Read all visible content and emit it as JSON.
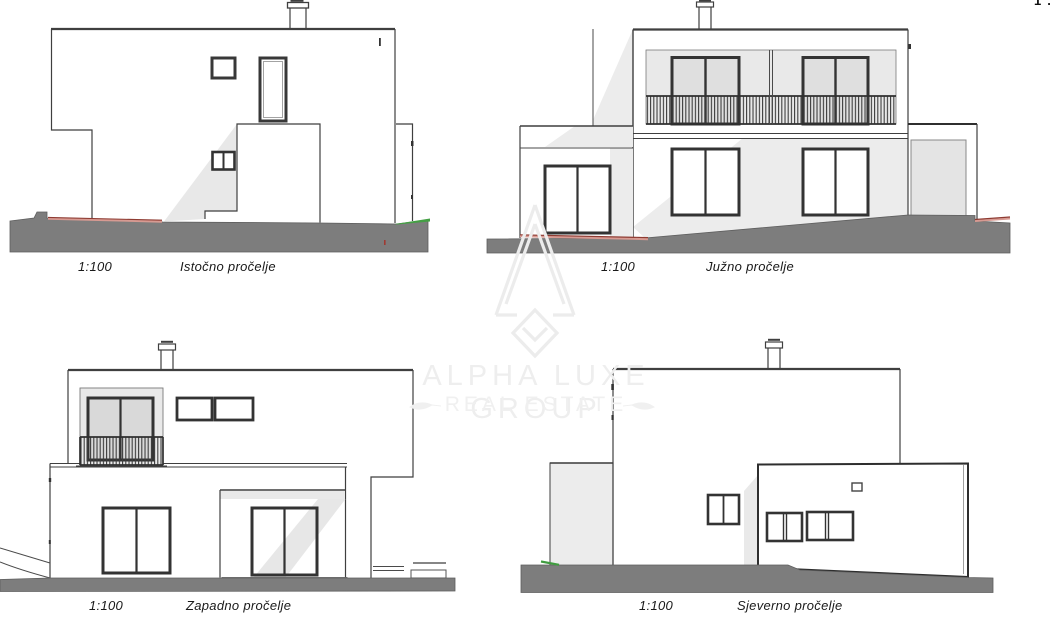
{
  "sheet": {
    "type": "architectural-elevations",
    "background": "#ffffff",
    "drawing_scale": "1:100"
  },
  "elevations": [
    {
      "id": "east",
      "scale_label": "1:100",
      "name_label": "Istočno pročelje"
    },
    {
      "id": "south",
      "scale_label": "1:100",
      "name_label": "Južno pročelje"
    },
    {
      "id": "west",
      "scale_label": "1:100",
      "name_label": "Zapadno pročelje"
    },
    {
      "id": "north",
      "scale_label": "1:100",
      "name_label": "Sjeverno pročelje"
    }
  ],
  "watermark": {
    "line1": "ALPHA LUXE GROUP",
    "line2": "REAL ESTATE",
    "logo": "alpha-luxe-pyramid-logo",
    "color": "#eeeeee"
  },
  "corner_fragment": {
    "text": "1."
  },
  "colors": {
    "ground": "#7d7d7d",
    "line": "#3f3f3f",
    "shading": "#e9e9e9",
    "terrain_red": "#8e3b32",
    "terrain_red_light": "#d79a92",
    "terrain_green": "#3f9b3f"
  }
}
